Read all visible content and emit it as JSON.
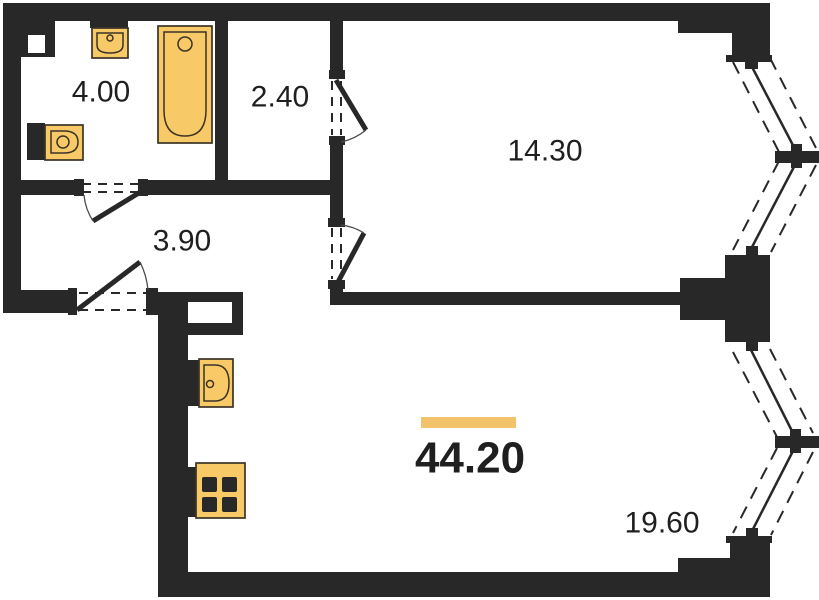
{
  "floorplan": {
    "total_area": {
      "value": "44.20"
    },
    "rooms": [
      {
        "id": "bathroom",
        "area": "4.00"
      },
      {
        "id": "storage",
        "area": "2.40"
      },
      {
        "id": "bedroom",
        "area": "14.30"
      },
      {
        "id": "hallway",
        "area": "3.90"
      },
      {
        "id": "living-kitchen",
        "area": "19.60"
      }
    ],
    "fixtures": [
      "washbasin-icon",
      "bathtub-icon",
      "toilet-icon",
      "kitchen-sink-icon",
      "stove-icon"
    ],
    "colors": {
      "wall": "#282828",
      "fixture": "#F8C967",
      "outline": "#3A3326",
      "accent": "#F2C36B",
      "text": "#1F1F1F",
      "bg": "#FFFFFF"
    }
  }
}
